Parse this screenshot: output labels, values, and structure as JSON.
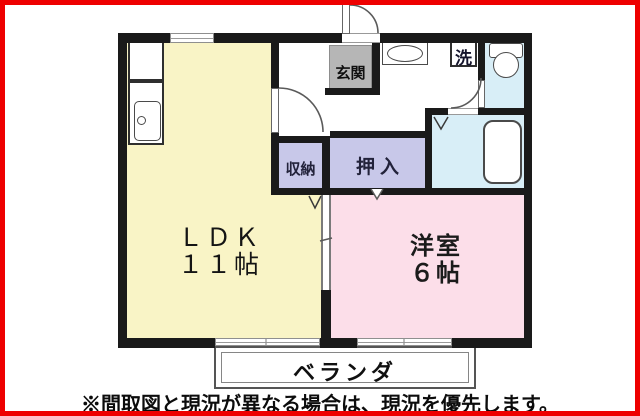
{
  "colors": {
    "frame_red": "#ee0000",
    "wall_black": "#1a1a1a",
    "ldk_yellow": "#f9f4c6",
    "western_pink": "#fcdee9",
    "closet_lavender": "#c8c8e9",
    "wet_area_blue": "#d8eef7",
    "entrance_gray": "#b6b6b6"
  },
  "rooms": {
    "ldk": {
      "name": "ＬＤＫ",
      "size": "１１帖"
    },
    "western": {
      "name": "洋室",
      "size": "６帖"
    },
    "storage": {
      "label": "収納"
    },
    "closet": {
      "label": "押入"
    },
    "entrance": {
      "label": "玄関"
    },
    "laundry": {
      "label": "洗"
    }
  },
  "balcony": {
    "label": "ベランダ"
  },
  "footer": {
    "disclaimer": "※間取図と現況が異なる場合は、現況を優先します。"
  },
  "icons": {
    "toilet": "toilet-icon",
    "bathtub": "bathtub-icon",
    "kitchen_sink": "kitchen-sink-icon",
    "washbasin": "washbasin-icon",
    "door_arcs": "door-arc-icon",
    "fold_door": "fold-door-v-icon"
  }
}
